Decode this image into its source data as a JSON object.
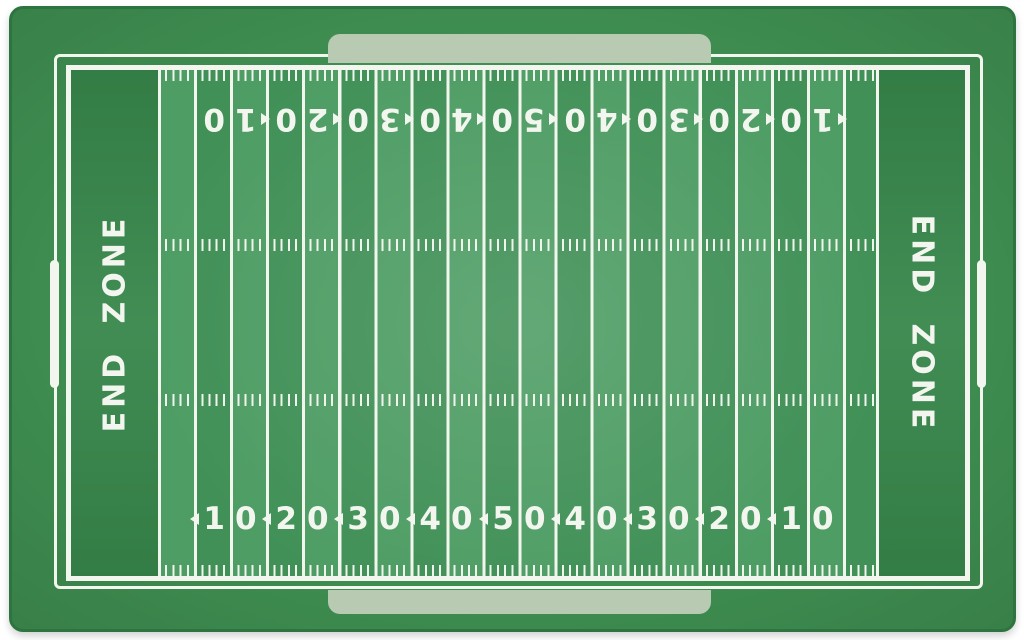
{
  "rug": {
    "description": "football-field-area-rug",
    "colors": {
      "background_white": "#ffffff",
      "rug_border_green": "#3f8f51",
      "edge_trim_green": "#2d7440",
      "field_green": "#43975b",
      "end_zone_green": "#37874b",
      "line_white": "#f3f6ef",
      "tab_sage": "#b8cab2"
    },
    "end_zone": {
      "label": "END ZONE"
    },
    "yard_numbers": [
      {
        "value": "10",
        "d1": "1",
        "d2": "0",
        "arrow": "left"
      },
      {
        "value": "20",
        "d1": "2",
        "d2": "0",
        "arrow": "left"
      },
      {
        "value": "30",
        "d1": "3",
        "d2": "0",
        "arrow": "left"
      },
      {
        "value": "40",
        "d1": "4",
        "d2": "0",
        "arrow": "left"
      },
      {
        "value": "50",
        "d1": "5",
        "d2": "0",
        "arrow": "left"
      },
      {
        "value": "40",
        "d1": "4",
        "d2": "0",
        "arrow": "left"
      },
      {
        "value": "30",
        "d1": "3",
        "d2": "0",
        "arrow": "left"
      },
      {
        "value": "20",
        "d1": "2",
        "d2": "0",
        "arrow": "left"
      },
      {
        "value": "10",
        "d1": "1",
        "d2": "0",
        "arrow": "left"
      }
    ],
    "field_layout": {
      "yard_line_interval_yards": 5,
      "top_numbers_orientation": "rotated-180",
      "bottom_numbers_orientation": "upright"
    }
  }
}
